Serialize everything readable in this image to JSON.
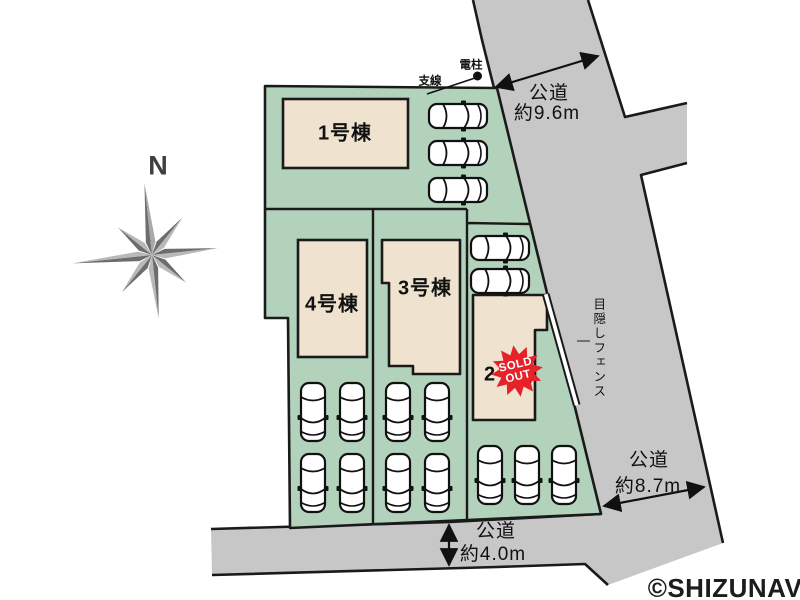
{
  "compass": {
    "north": "N"
  },
  "plots": {
    "building_1": {
      "label": "1号棟",
      "parking_cars": 3
    },
    "building_2": {
      "label": "2号棟",
      "sold_out": true,
      "parking_cars_front": 2,
      "parking_cars_bottom": 3
    },
    "building_3": {
      "label": "3号棟",
      "parking_cars": 4
    },
    "building_4": {
      "label": "4号棟",
      "parking_cars": 4
    }
  },
  "roads": {
    "top": {
      "name": "公道",
      "width": "約9.6m"
    },
    "right": {
      "name": "公道",
      "width": "約8.7m"
    },
    "bottom": {
      "name": "公道",
      "width": "約4.0m"
    }
  },
  "annotations": {
    "utility_pole": "電柱",
    "guy_wire": "支線",
    "privacy_fence": "目隠しフェンス"
  },
  "stamp": {
    "sold": "SOLD",
    "out": "OUT"
  },
  "watermark": "©SHIZUNAV",
  "colors": {
    "plot_green": "#b2d2bb",
    "road_gray": "#c7c7c7",
    "building_beige": "#efe3d0",
    "sold_out_red": "#e62129",
    "outline_black": "#1a1a1a"
  }
}
